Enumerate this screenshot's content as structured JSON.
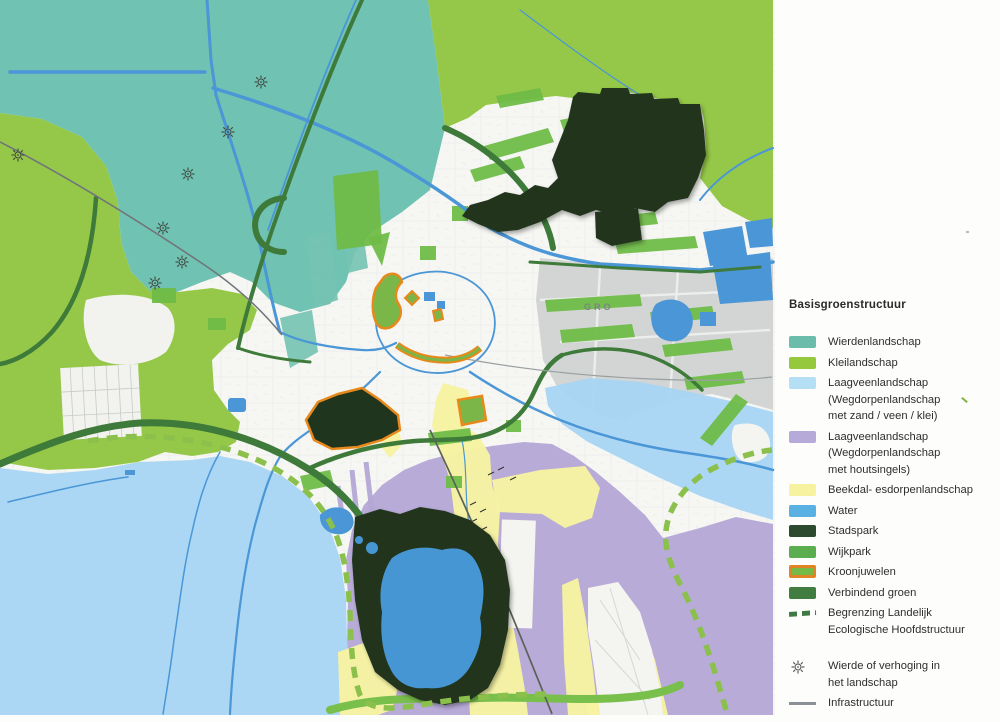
{
  "legend": {
    "title": "Basisgroenstructuur",
    "items": [
      {
        "label": "Wierdenlandschap",
        "color": "#6cbcab",
        "type": "fill"
      },
      {
        "label": "Kleilandschap",
        "color": "#96c83e",
        "type": "fill"
      },
      {
        "label": "Laagveenlandschap",
        "label2": "(Wegdorpenlandschap",
        "label3": "met zand / veen / klei)",
        "color": "#b5dff5",
        "type": "fill"
      },
      {
        "label": "Laagveenlandschap",
        "label2": "(Wegdorpenlandschap",
        "label3": "met houtsingels)",
        "color": "#b6aad8",
        "type": "fill"
      },
      {
        "label": "Beekdal- esdorpenlandschap",
        "color": "#f6f2a0",
        "type": "fill"
      },
      {
        "label": "Water",
        "color": "#59b1e3",
        "type": "fill"
      },
      {
        "label": "Stadspark",
        "color": "#2c4a2e",
        "type": "fill"
      },
      {
        "label": "Wijkpark",
        "color": "#5aae50",
        "type": "fill"
      },
      {
        "label": "Kroonjuwelen",
        "color": "#76b944",
        "border_color": "#e08426",
        "type": "outlined-fill"
      },
      {
        "label": "Verbindend groen",
        "color": "#417c41",
        "type": "fill"
      },
      {
        "label": "Begrenzing Landelijk",
        "label2": "Ecologische Hoofdstructuur",
        "color": "#3f7a44",
        "type": "dashed-line"
      },
      {
        "label": "Wierde of verhoging in",
        "label2": "het landschap",
        "symbol": "wierde-star",
        "type": "symbol"
      },
      {
        "label": "Infrastructuur",
        "color": "#8b9196",
        "type": "line"
      }
    ]
  },
  "map": {
    "base_label_fragment": "GRO",
    "colors": {
      "wierdenlandschap": "#68bfae",
      "kleilandschap": "#8fc53e",
      "laagveen_zand_veen_klei": "#a7d5f3",
      "laagveen_houtsingels": "#b4a7d6",
      "beekdal": "#f7f3a2",
      "water": "#4a96d6",
      "stadspark": "#20351e",
      "wijkpark": "#6fbc48",
      "kroonjuwelen_outline": "#e8891c",
      "verbindend_groen": "#3e7a3a",
      "eco_boundary_dash": "#8cc04c",
      "infrastructuur": "#70767a",
      "industrial_gray": "#cfd2d0"
    }
  }
}
